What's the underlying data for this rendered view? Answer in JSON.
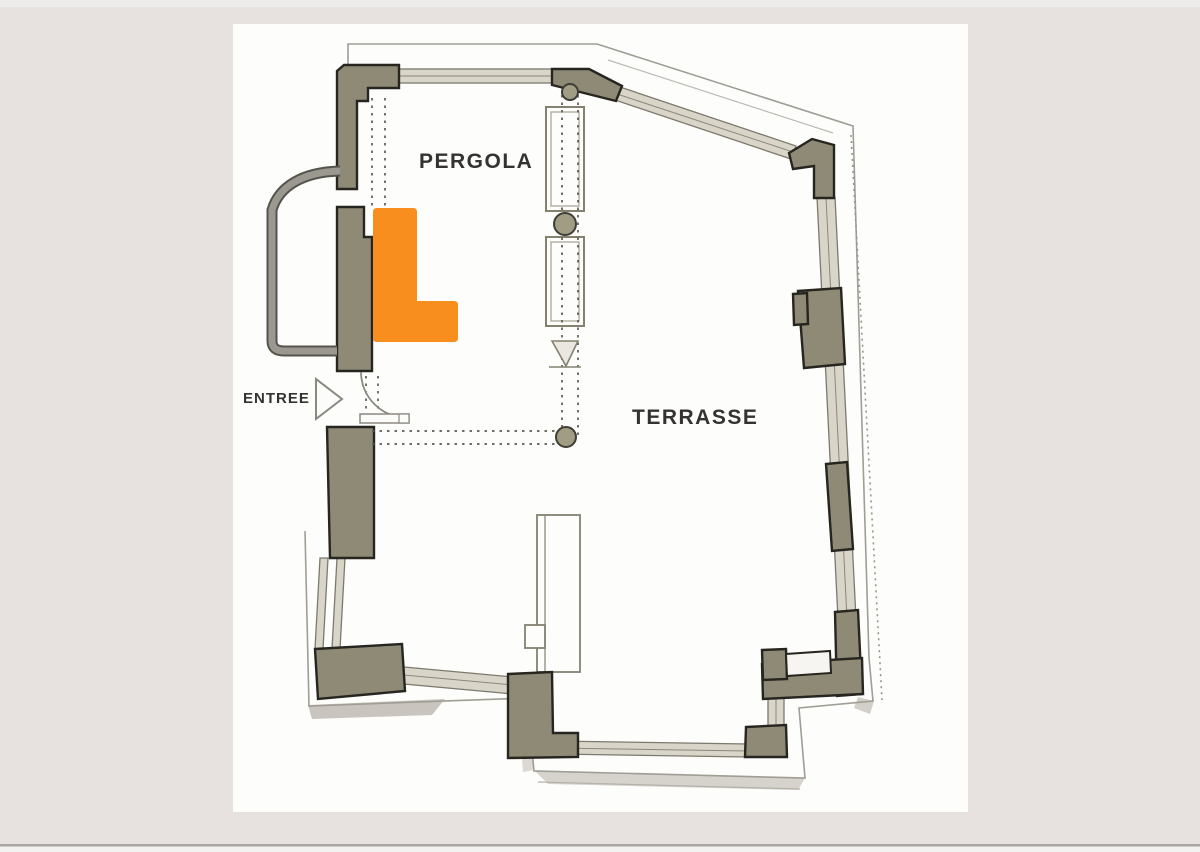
{
  "plan": {
    "labels": {
      "pergola": "PERGOLA",
      "terrasse": "TERRASSE",
      "entree": "ENTREE"
    },
    "colors": {
      "background": "#e7e2df",
      "paper": "#fdfdfc",
      "wall_olive": "#8f8a75",
      "wall_outline": "#26251f",
      "glazing_fill": "#d9d6c9",
      "glazing_edge": "#7c796d",
      "line_gray": "#8b8880",
      "dashed_line": "#5c5a52",
      "highlight_orange": "#f78e1e",
      "text": "#343330",
      "shadow": "#ccc8c1",
      "bottom_divider": "#aaa7a2"
    },
    "icons": {
      "entree_arrow": "right-pointing-triangle-arrow"
    }
  }
}
